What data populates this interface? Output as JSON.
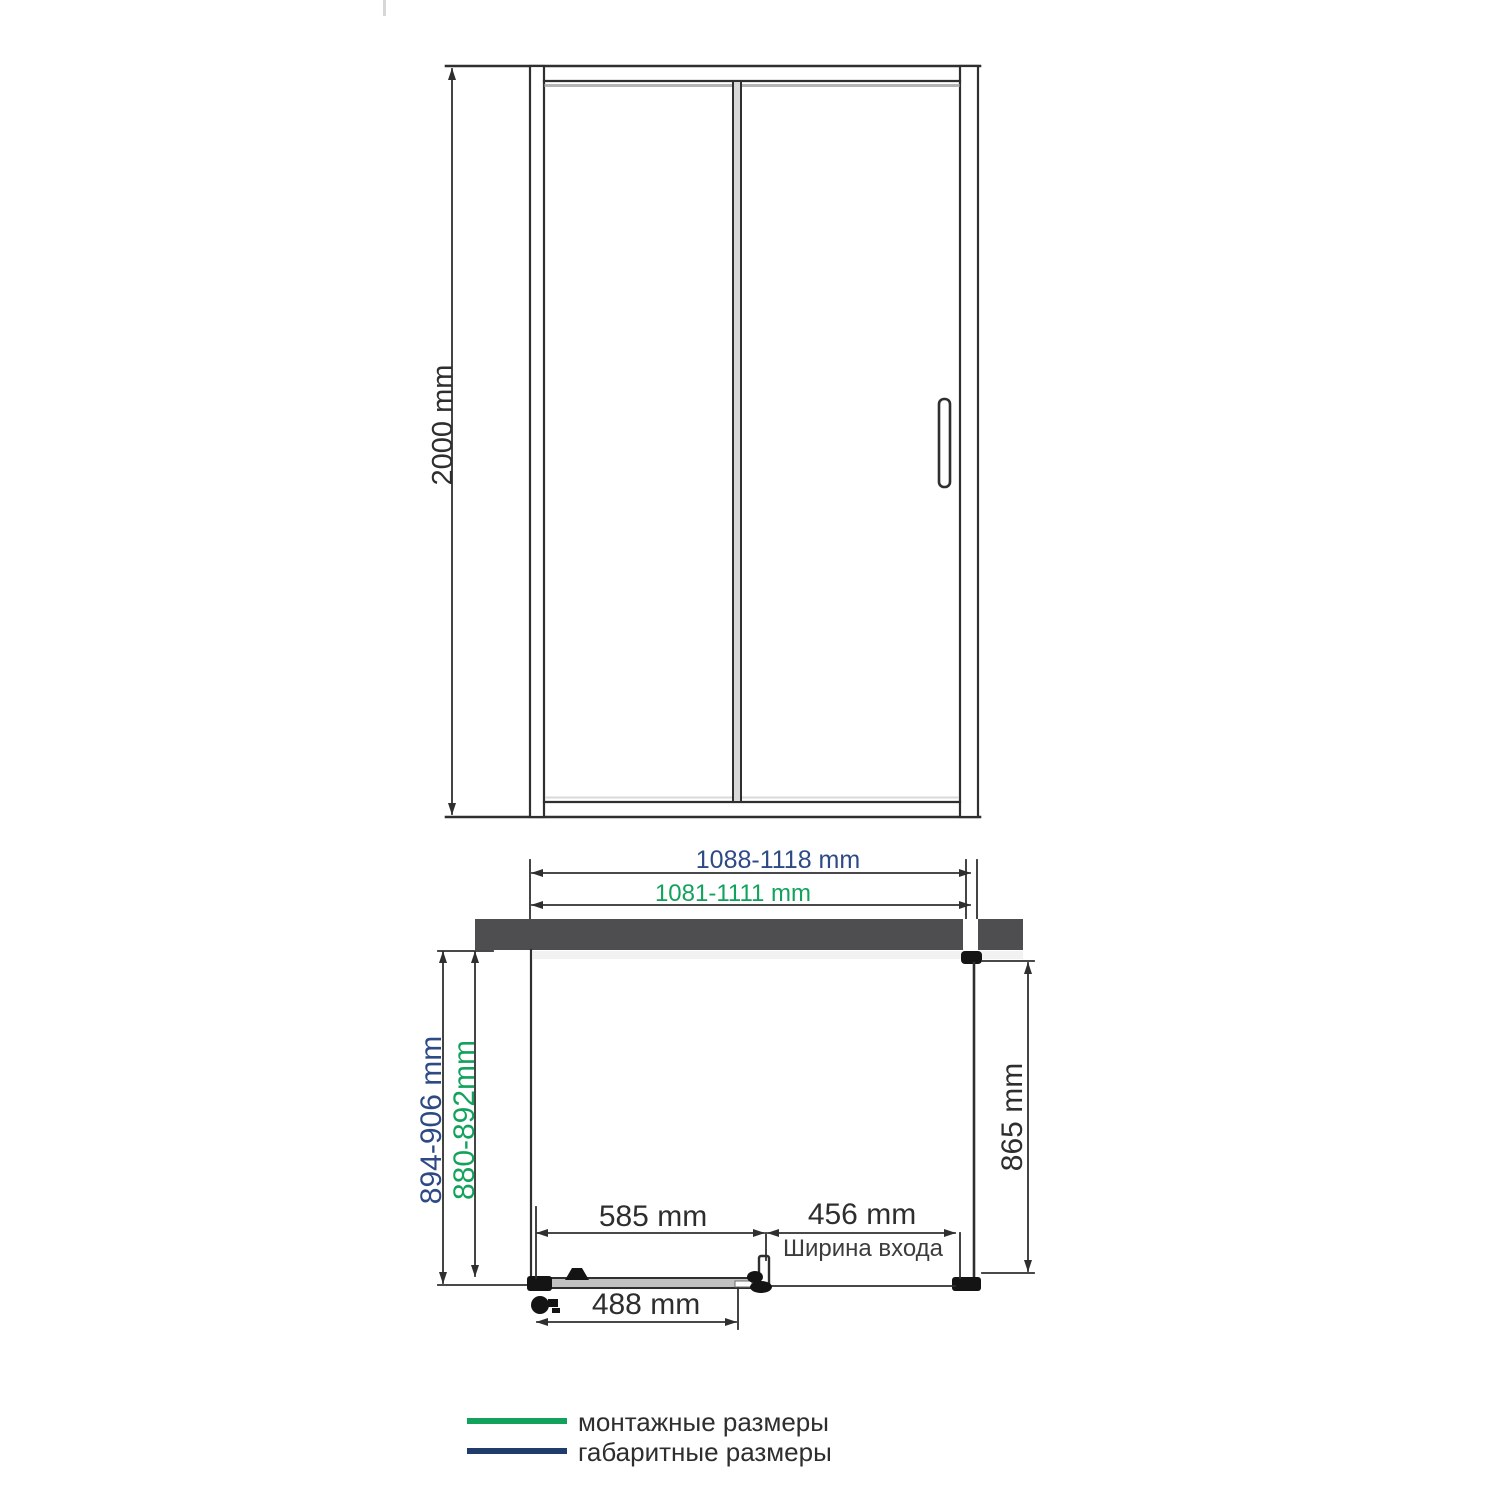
{
  "front_view": {
    "height_dim": "2000 mm"
  },
  "plan_view": {
    "overall_width": "1088-1118 mm",
    "mounting_width": "1081-1111 mm",
    "overall_depth": "894-906 mm",
    "mounting_depth": "880-892mm",
    "side_glass": "865 mm",
    "fixed_glass": "585 mm",
    "entry_width": "456 mm",
    "entry_label": "Ширина входа",
    "slider_glass": "488 mm"
  },
  "legend": {
    "mounting": "монтажные размеры",
    "overall": "габаритные размеры"
  },
  "colors": {
    "dim_blue": "#2d4a85",
    "dim_green": "#12a25c",
    "legend_blue": "#1f3c6b",
    "legend_green": "#12a25c",
    "wall_bar": "#4e4e50",
    "line": "#2f2f2f"
  }
}
